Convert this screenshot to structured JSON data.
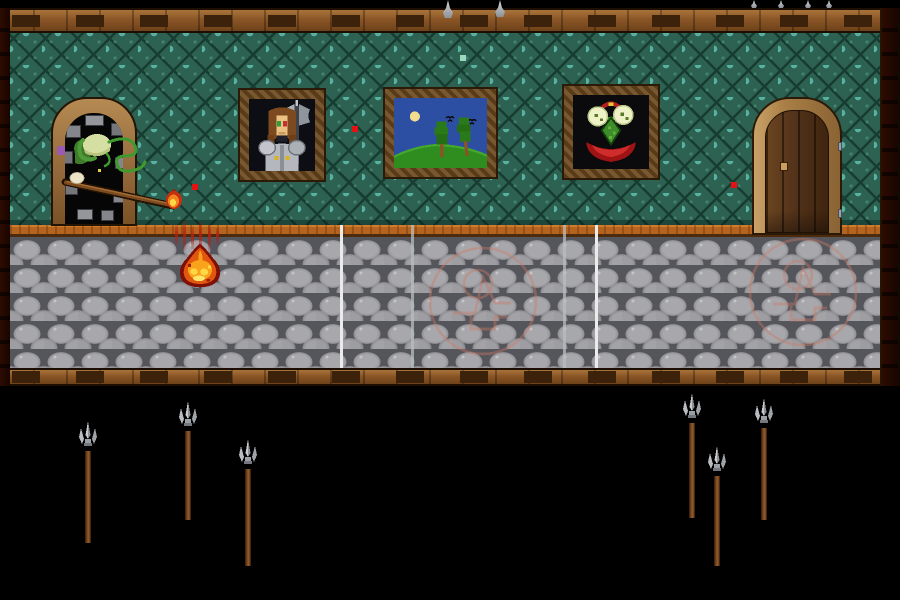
{
  "scene": {
    "description": "pixel-art dungeon corridor: green lattice wallpaper, cobblestone floor, goblin lurking in a dark doorway thrusting a burning spear, three wall paintings, a closed wooden door, spear pit below",
    "width": 900,
    "height": 600
  },
  "colors": {
    "background": "#000000",
    "wood_beam": "#8a5526",
    "wood_beam_dark": "#3c220a",
    "wood_beam_light": "#a9743a",
    "wallpaper_base": "#2d6253",
    "wallpaper_lattice": "#173c30",
    "wallpaper_dot": "#58b2a2",
    "baseboard_orange": "#b4641e",
    "floor_stone": "#a2a2a6",
    "floor_joint": "#55555c",
    "floor_line_bright": "#ebebeb",
    "floor_line_faint": "#b9bdbd",
    "sigil": "#cd7a64",
    "doorway_frame_tan": "#a87c46",
    "door_wood": "#5c3a1b",
    "goblin_skin": "#d6dfa2",
    "goblin_green": "#4f9a38",
    "fire_outline": "#7e1006",
    "fire_body": "#e2570f",
    "fire_inner": "#f9a21b",
    "fire_core": "#ffd845",
    "particle_red": "#e31214",
    "sparkle_mint": "#9adbc0",
    "spear_metal": "#b9bdc1",
    "spear_shaft": "#7a4a22"
  },
  "layout": {
    "beam_top": {
      "x": 0,
      "y": 8,
      "w": 900,
      "h": 25
    },
    "beam_bottom": {
      "x": 0,
      "y": 368,
      "w": 900,
      "h": 18
    },
    "beam_left": {
      "x": 0,
      "y": 8,
      "w": 10,
      "h": 378
    },
    "beam_right": {
      "x": 880,
      "y": 8,
      "w": 20,
      "h": 378
    },
    "wall": {
      "x": 10,
      "y": 33,
      "w": 870,
      "h": 192
    },
    "baseboard": {
      "x": 10,
      "y": 225,
      "w": 870,
      "h": 12
    },
    "floor": {
      "x": 10,
      "y": 237,
      "w": 870,
      "h": 131
    },
    "lines_layer": {
      "x": 0,
      "y": 225,
      "w": 900,
      "h": 143
    },
    "doorway_left": {
      "x": 51,
      "y": 97,
      "w": 86,
      "h": 129
    },
    "door_right": {
      "x": 752,
      "y": 97,
      "w": 90,
      "h": 138
    },
    "painting_knight": {
      "x": 238,
      "y": 88,
      "w": 88,
      "h": 94
    },
    "painting_landscape": {
      "x": 383,
      "y": 87,
      "w": 115,
      "h": 92
    },
    "painting_plant": {
      "x": 562,
      "y": 84,
      "w": 98,
      "h": 96
    },
    "goblin": {
      "x": 53,
      "y": 128,
      "w": 140,
      "h": 88
    },
    "floor_fire": {
      "x": 175,
      "y": 242,
      "w": 50,
      "h": 46
    }
  },
  "entities": {
    "goblin": {
      "name": "goblin lurker",
      "holding": "spear with burning tip"
    },
    "paintings": [
      {
        "subject": "knight portrait with double-bladed axe"
      },
      {
        "subject": "landscape with sun, birds and two trees"
      },
      {
        "subject": "carnivorous plant with two pale blossoms and red maw"
      }
    ],
    "doors": [
      {
        "side": "left",
        "type": "dark stone doorway opening"
      },
      {
        "side": "right",
        "type": "closed wooden door with handle and hinges"
      }
    ],
    "floor_fire": {
      "name": "burning flame on floor"
    }
  },
  "hazards": {
    "top_spear_tips": [
      {
        "x": 443,
        "w": 10,
        "h": 18
      },
      {
        "x": 495,
        "w": 10,
        "h": 17
      },
      {
        "x": 751,
        "w": 6,
        "h": 8
      },
      {
        "x": 778,
        "w": 6,
        "h": 8
      },
      {
        "x": 805,
        "w": 6,
        "h": 8
      },
      {
        "x": 826,
        "w": 6,
        "h": 8
      }
    ],
    "bottom_spears": [
      {
        "x": 88,
        "top": 421,
        "bottom": 540
      },
      {
        "x": 188,
        "top": 401,
        "bottom": 517
      },
      {
        "x": 248,
        "top": 439,
        "bottom": 563
      },
      {
        "x": 692,
        "top": 393,
        "bottom": 515
      },
      {
        "x": 717,
        "top": 446,
        "bottom": 563
      },
      {
        "x": 764,
        "top": 398,
        "bottom": 517
      }
    ]
  },
  "particles": {
    "red_squares": [
      {
        "x": 352,
        "y": 126,
        "s": 6
      },
      {
        "x": 192,
        "y": 184,
        "s": 6
      },
      {
        "x": 731,
        "y": 182,
        "s": 6
      }
    ],
    "sparkles": [
      {
        "x": 460,
        "y": 55,
        "s": 6
      }
    ],
    "ember_streaks": [
      {
        "x": 175,
        "y": 225,
        "h": 20
      },
      {
        "x": 183,
        "y": 221,
        "h": 29
      },
      {
        "x": 191,
        "y": 226,
        "h": 23
      },
      {
        "x": 199,
        "y": 222,
        "h": 28
      },
      {
        "x": 208,
        "y": 225,
        "h": 25
      },
      {
        "x": 216,
        "y": 228,
        "h": 17
      }
    ]
  },
  "floor_markings": {
    "white_lines": [
      {
        "x": 340,
        "bright": true
      },
      {
        "x": 411,
        "bright": false
      },
      {
        "x": 563,
        "bright": false
      },
      {
        "x": 595,
        "bright": true
      }
    ],
    "sigils": [
      {
        "cx": 483,
        "cy": 301,
        "r": 53
      },
      {
        "cx": 803,
        "cy": 292,
        "r": 53
      }
    ]
  }
}
